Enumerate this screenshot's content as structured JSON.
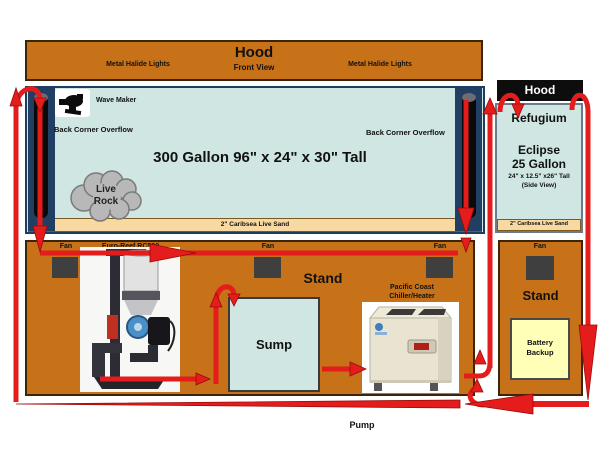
{
  "diagram": {
    "hood_main": {
      "title": "Hood",
      "subtitle": "Front View",
      "left_label": "Metal Halide Lights",
      "right_label": "Metal Halide Lights"
    },
    "tank": {
      "label": "300 Gallon 96\" x 24\" x 30\" Tall",
      "wave_maker_label": "Wave Maker",
      "overflow_left_label": "Back Corner Overflow",
      "overflow_right_label": "Back Corner Overflow",
      "live_rock_line1": "Live",
      "live_rock_line2": "Rock",
      "sand_label": "2\" Caribsea Live Sand"
    },
    "stand_main": {
      "label": "Stand",
      "fan1": "Fan",
      "fan2": "Fan",
      "fan3": "Fan",
      "skimmer_label": "Euro-Reef RC500",
      "sump_label": "Sump",
      "chiller_line1": "Pacific Coast",
      "chiller_line2": "Chiller/Heater"
    },
    "refugium": {
      "hood_label": "Hood",
      "title": "Refugium",
      "model": "Eclipse",
      "capacity": "25 Gallon",
      "dimensions": "24\" x 12.5\" x26\" Tall",
      "view_note": "(Side View)",
      "sand_label": "2\" Caribsea Live Sand"
    },
    "stand_right": {
      "label": "Stand",
      "fan": "Fan",
      "battery_line1": "Battery",
      "battery_line2": "Backup"
    },
    "pump_label": "Pump",
    "colors": {
      "cabinet_orange": "#c77119",
      "water_blue": "#cfe6e2",
      "sand_tan": "#f8d9a2",
      "flow_red": "#e51c1c",
      "overflow_navy": "#203f63",
      "battery_yellow": "#ffffb8",
      "hood_black": "#0d0d0d"
    }
  }
}
